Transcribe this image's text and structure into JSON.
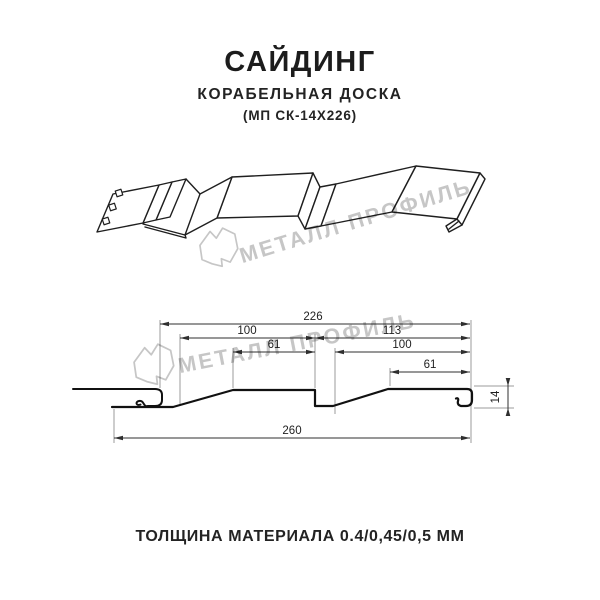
{
  "header": {
    "title": "САЙДИНГ",
    "subtitle": "КОРАБЕЛЬНАЯ ДОСКА",
    "code": "(МП СК-14Х226)"
  },
  "watermark": {
    "brand": "МЕТАЛЛ ПРОФИЛЬ"
  },
  "section_dims": {
    "total_width": "226",
    "left_pitch": "100",
    "right_pitch": "113",
    "left_flat": "61",
    "right_inner": "100",
    "right_flat": "61",
    "overall_width": "260",
    "profile_height": "14"
  },
  "footer": {
    "thickness": "ТОЛЩИНА МАТЕРИАЛА 0.4/0,45/0,5 ММ"
  },
  "colors": {
    "line": "#1f1f1f",
    "dimension": "#2f2f2f",
    "extension": "#9b9b9b",
    "watermark": "#c6c6c6",
    "background": "#ffffff"
  }
}
